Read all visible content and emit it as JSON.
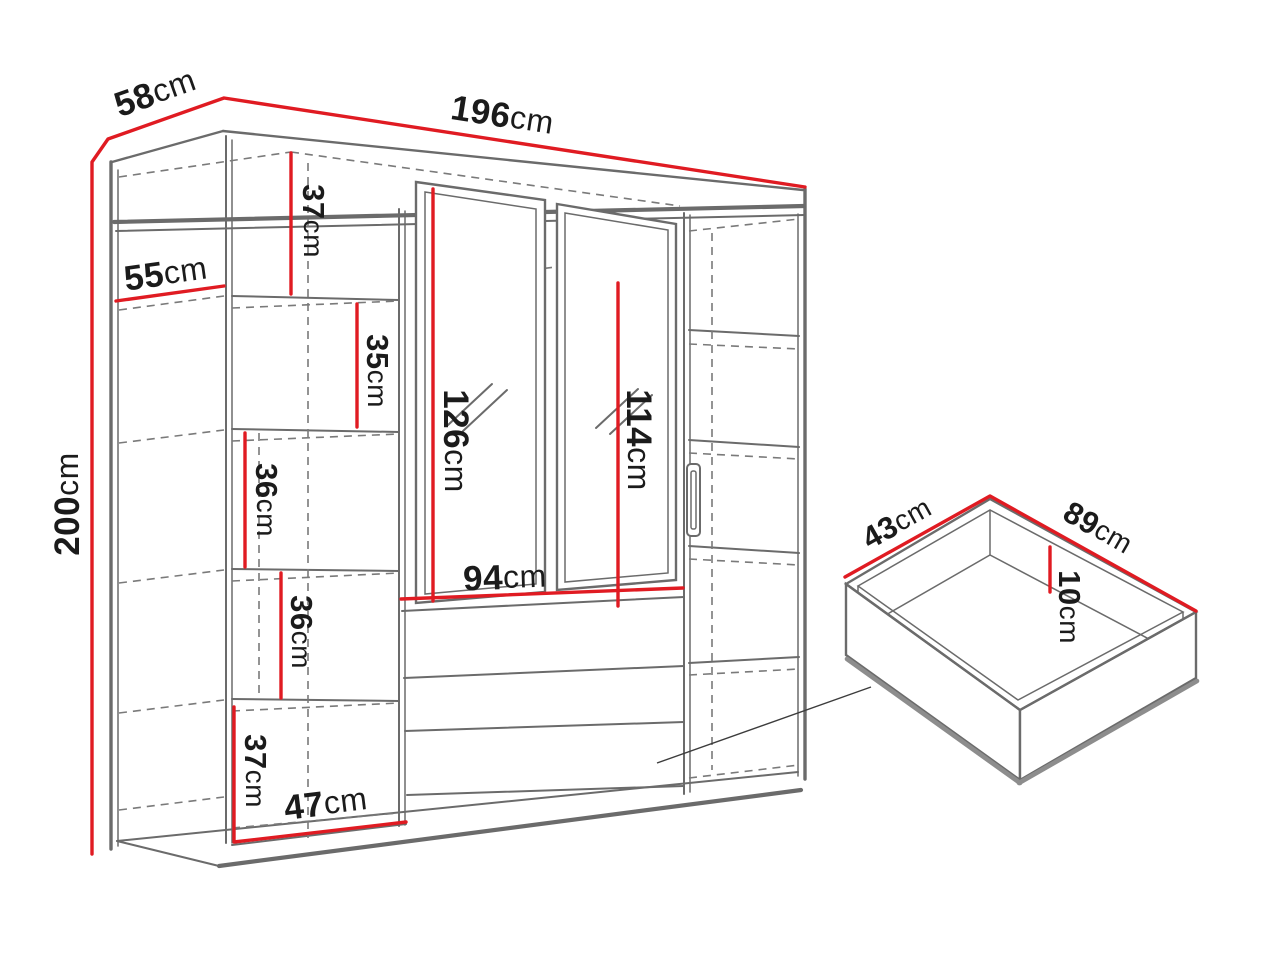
{
  "diagram": {
    "kind": "furniture dimension drawing",
    "colors": {
      "dimension_line": "#e01b22",
      "structure_line": "#6b6b6b",
      "text": "#1b1b1b"
    }
  },
  "dims": {
    "width": {
      "v": "196",
      "u": "cm"
    },
    "depth": {
      "v": "58",
      "u": "cm"
    },
    "height": {
      "v": "200",
      "u": "cm"
    },
    "side_depth": {
      "v": "55",
      "u": "cm"
    },
    "gap1": {
      "v": "37",
      "u": "cm"
    },
    "gap2": {
      "v": "35",
      "u": "cm"
    },
    "gap3": {
      "v": "36",
      "u": "cm"
    },
    "gap4": {
      "v": "36",
      "u": "cm"
    },
    "gap5": {
      "v": "37",
      "u": "cm"
    },
    "shelf_width": {
      "v": "47",
      "u": "cm"
    },
    "mirror_left_h": {
      "v": "126",
      "u": "cm"
    },
    "mirror_right_h": {
      "v": "114",
      "u": "cm"
    },
    "mirror_w": {
      "v": "94",
      "u": "cm"
    },
    "drawer_depth": {
      "v": "43",
      "u": "cm"
    },
    "drawer_width": {
      "v": "89",
      "u": "cm"
    },
    "drawer_height": {
      "v": "10",
      "u": "cm"
    }
  }
}
